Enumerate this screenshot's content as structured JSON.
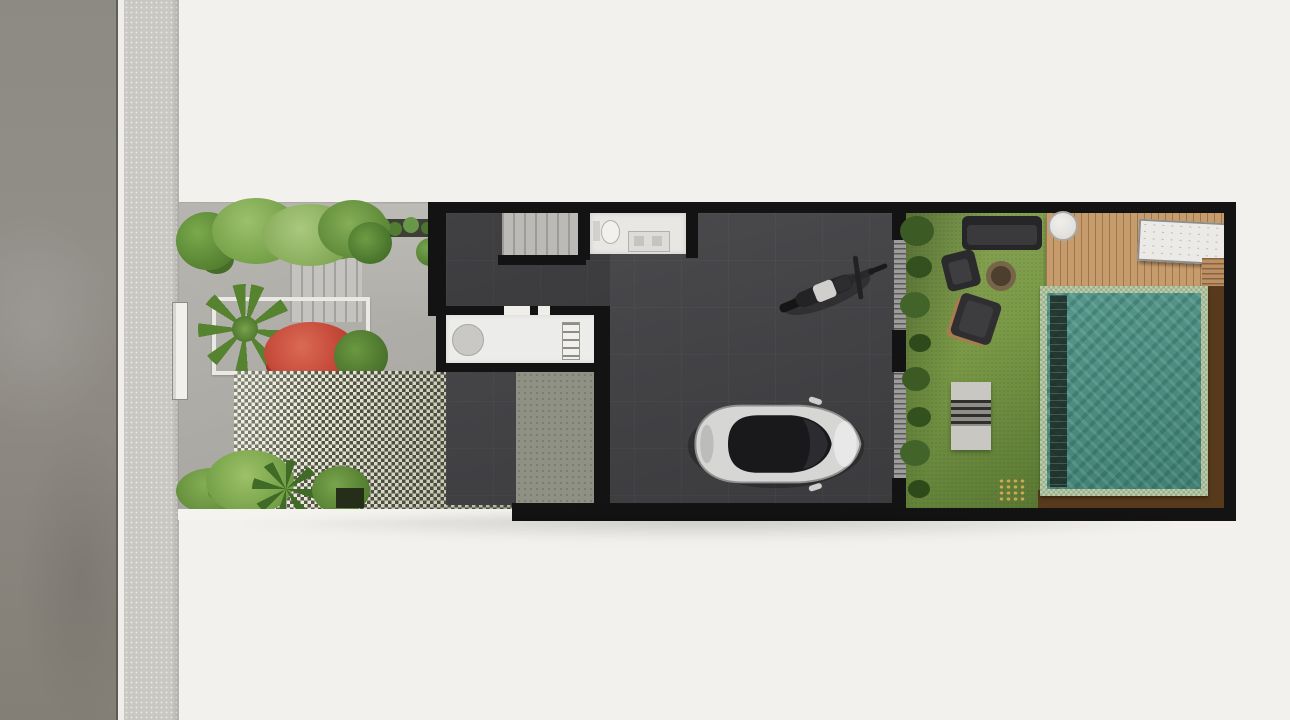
{
  "scene_title": "Top-down architectural site plan render of a narrow row house",
  "colors": {
    "bg": "#f2f1ee",
    "road": "#8b8781",
    "sidewalk": "#cac8c3",
    "paving": "#b3b1ac",
    "checker-light": "#e9e7dd",
    "checker-dark": "#50543d",
    "wall": "#141313",
    "floor-a": "#4c4c4f",
    "floor-b": "#3b3b3e",
    "stairs": "#bbbab7",
    "bath": "#e9e7e4",
    "counter": "#ececea",
    "lawn-a": "#7b9a47",
    "lawn-b": "#597733",
    "hedge": "#3c5a24",
    "deck": "#c79c6d",
    "pool-tile": "#bccdab",
    "pool-water": "#57988c",
    "pool-water-deep": "#417f74",
    "wood": "#57391b",
    "leaf-light": "#9cc06c",
    "leaf-mid": "#6f9c43",
    "leaf-dark": "#45702a",
    "red-bush": "#bf3f31",
    "car-body": "#d6d6d5",
    "car-glass": "#19191b",
    "vehicle-dark": "#232325",
    "furniture-dark": "#2b2b2d"
  },
  "objects": {
    "street": "asphalt street",
    "sidewalk": "textured sidewalk strip",
    "courtyard": "front courtyard with gray paving",
    "entry_steps": "entry steps",
    "palm": "palm plant in planter",
    "red_bush": "red flowering bush",
    "checker_paving": "grass-block checkered paving (carport forecourt)",
    "gate_post": "white gate post",
    "stairs": "interior staircase",
    "bathroom": "bathroom with toilet and vanity",
    "kitchen": "kitchen counter with round sink and cooktop",
    "side_passage": "side service passage",
    "garage": "dark garage / carport floor",
    "motorcycle": "parked motorcycle, top view",
    "car": "white car, top view",
    "garage_door": "louvered garage screen wall",
    "lawn": "backyard lawn",
    "hedge": "hedge along backyard wall",
    "sofa": "outdoor sofa",
    "armchair": "outdoor armchair",
    "fire_pit": "round fire pit",
    "lounge_chair": "lounge chair",
    "bench_set": "outdoor bench / table set",
    "deck": "wooden pool deck",
    "round_table": "round white deck table",
    "sun_lounger": "white sun lounger",
    "deck_steps": "deck steps",
    "pool": "tiled swimming pool",
    "pool_lane": "pool shadow lane / bench",
    "wood_border": "dark wood pool surround"
  }
}
